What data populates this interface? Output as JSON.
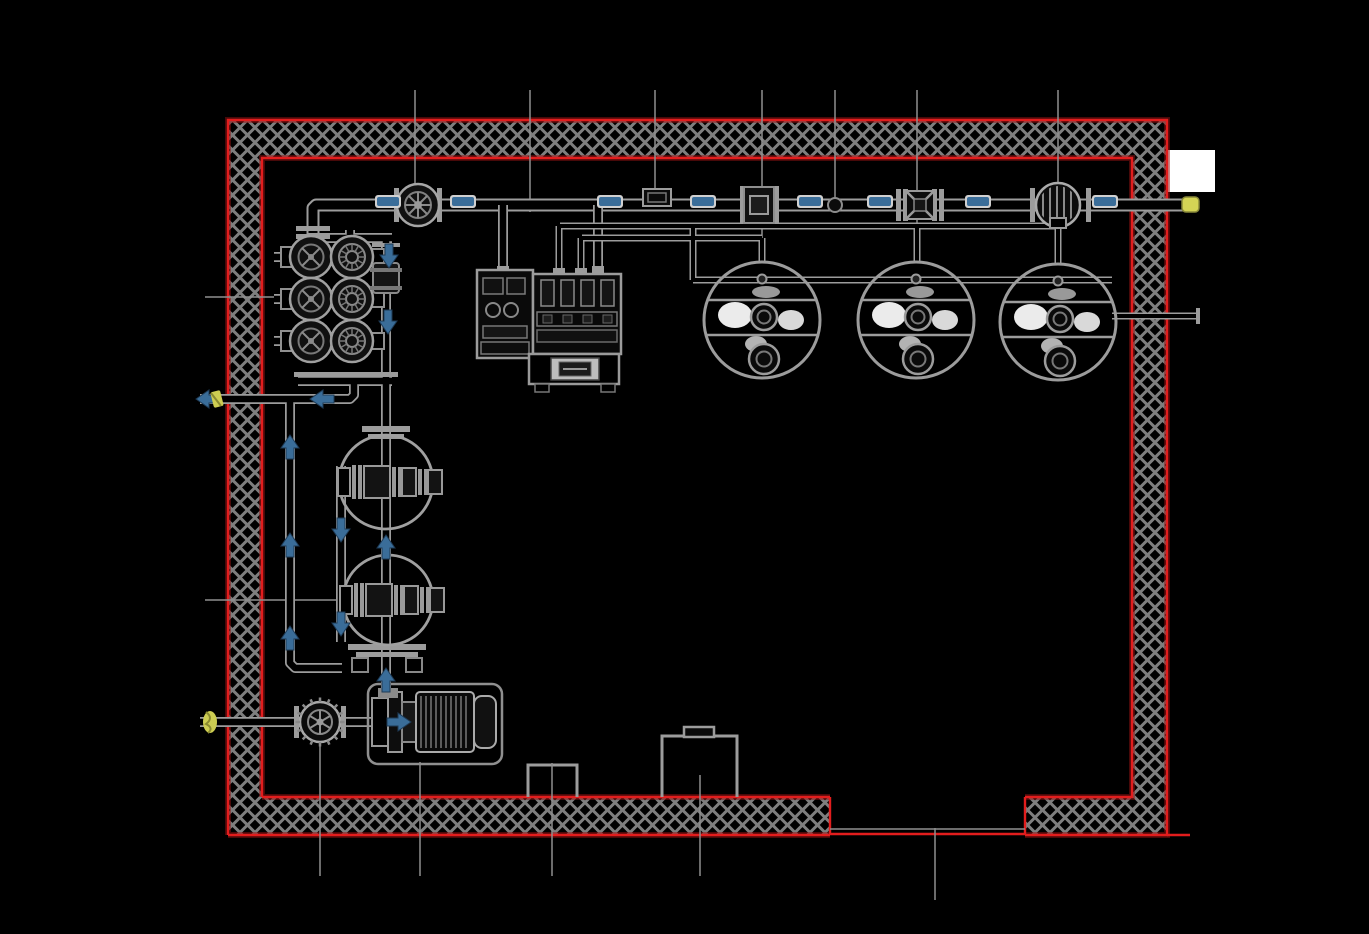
{
  "document": {
    "type": "engineering-drawing",
    "view": "plan",
    "subject": "mechanical equipment room piping layout",
    "visible_text": "none"
  },
  "colors": {
    "background": "#000000",
    "linework_gray": "#9c9c9c",
    "linework_dim": "#787878",
    "grid_gray": "#8f8f8f",
    "wall_hatch_gray": "#7e7e7e",
    "wall_outline_red": "#e21d1d",
    "flow_marker_blue": "#3a6d99",
    "marker_halo_white": "#d0d0d0",
    "penetration_yellow": "#cdcd52",
    "white_patch": "#ffffff",
    "equipment_dark": "#101010"
  },
  "room": {
    "walls": [
      "top",
      "left",
      "right",
      "bottom-left-segment",
      "bottom-right-segment"
    ],
    "wall_style": "cross-hatched with red edge lines",
    "door_opening": {
      "wall": "bottom",
      "x1": 830,
      "x2": 1025
    },
    "niches": [
      {
        "name": "small-floor-recess",
        "x": 528,
        "y": 765,
        "w": 49,
        "h": 32
      },
      {
        "name": "large-floor-recess",
        "x": 662,
        "y": 736,
        "w": 75,
        "h": 61
      }
    ]
  },
  "equipment": {
    "tanks": [
      {
        "id": "tank-1",
        "cx": 762,
        "cy": 320,
        "r": 58
      },
      {
        "id": "tank-2",
        "cx": 916,
        "cy": 320,
        "r": 58
      },
      {
        "id": "tank-3",
        "cx": 1058,
        "cy": 322,
        "r": 58
      }
    ],
    "main_line_components": [
      {
        "name": "gate-valve-handwheel",
        "x": 418
      },
      {
        "name": "inline-instrument",
        "x": 657
      },
      {
        "name": "flanged-valve-spool",
        "x": 759
      },
      {
        "name": "weld-point-dot",
        "x": 835
      },
      {
        "name": "cross-gate-valve",
        "x": 920
      },
      {
        "name": "strainer-meter",
        "x": 1058
      }
    ],
    "valve_manifold": {
      "columns": 2,
      "rows": 3,
      "row_y": [
        257,
        299,
        341
      ],
      "col_x": [
        311,
        352
      ]
    },
    "duplex_vessel": {
      "circles": [
        {
          "cx": 386,
          "cy": 482,
          "r": 47
        },
        {
          "cx": 388,
          "cy": 600,
          "r": 45
        }
      ]
    },
    "pump_unit": {
      "x": 368,
      "y": 684,
      "w": 134,
      "h": 80,
      "type": "motor-driven centrifugal pump"
    },
    "suction_valve": {
      "cx": 320,
      "cy": 722,
      "r": 20
    },
    "equipment_skid": {
      "x": 477,
      "y": 266,
      "w": 145,
      "h": 126
    }
  },
  "flow_markers": {
    "dashes_y": 202,
    "dashes_x": [
      388,
      463,
      610,
      703,
      810,
      880,
      978,
      1105
    ],
    "arrows": [
      {
        "x": 389,
        "y": 256,
        "dir": "down"
      },
      {
        "x": 388,
        "y": 322,
        "dir": "down"
      },
      {
        "x": 322,
        "y": 399,
        "dir": "left"
      },
      {
        "x": 208,
        "y": 399,
        "dir": "left"
      },
      {
        "x": 290,
        "y": 447,
        "dir": "up"
      },
      {
        "x": 290,
        "y": 545,
        "dir": "up"
      },
      {
        "x": 290,
        "y": 638,
        "dir": "up"
      },
      {
        "x": 341,
        "y": 530,
        "dir": "down"
      },
      {
        "x": 341,
        "y": 624,
        "dir": "down"
      },
      {
        "x": 386,
        "y": 547,
        "dir": "up"
      },
      {
        "x": 386,
        "y": 680,
        "dir": "up"
      },
      {
        "x": 399,
        "y": 722,
        "dir": "right"
      }
    ]
  },
  "grid_lines": {
    "vertical_top": [
      {
        "x": 415,
        "y1": 90,
        "y2": 184
      },
      {
        "x": 530,
        "y1": 90,
        "y2": 212
      },
      {
        "x": 655,
        "y1": 90,
        "y2": 192
      },
      {
        "x": 762,
        "y1": 90,
        "y2": 262
      },
      {
        "x": 835,
        "y1": 90,
        "y2": 199
      },
      {
        "x": 917,
        "y1": 90,
        "y2": 260
      },
      {
        "x": 1058,
        "y1": 90,
        "y2": 264
      }
    ],
    "vertical_bottom": [
      {
        "x": 320,
        "y1": 742,
        "y2": 876
      },
      {
        "x": 420,
        "y1": 762,
        "y2": 876
      },
      {
        "x": 552,
        "y1": 763,
        "y2": 876
      },
      {
        "x": 700,
        "y1": 775,
        "y2": 876
      },
      {
        "x": 935,
        "y1": 828,
        "y2": 900
      }
    ],
    "horizontal_left": [
      {
        "y": 297,
        "x1": 205,
        "x2": 276
      },
      {
        "y": 600,
        "x1": 205,
        "x2": 344
      }
    ]
  },
  "wall_penetrations": [
    {
      "wall": "left",
      "y": 399,
      "marker": "yellow-tag"
    },
    {
      "wall": "left",
      "y": 722,
      "marker": "yellow-tag"
    },
    {
      "wall": "right",
      "y": 205,
      "marker": "yellow-cap"
    },
    {
      "wall": "right",
      "y": 316,
      "marker": "plain"
    }
  ]
}
